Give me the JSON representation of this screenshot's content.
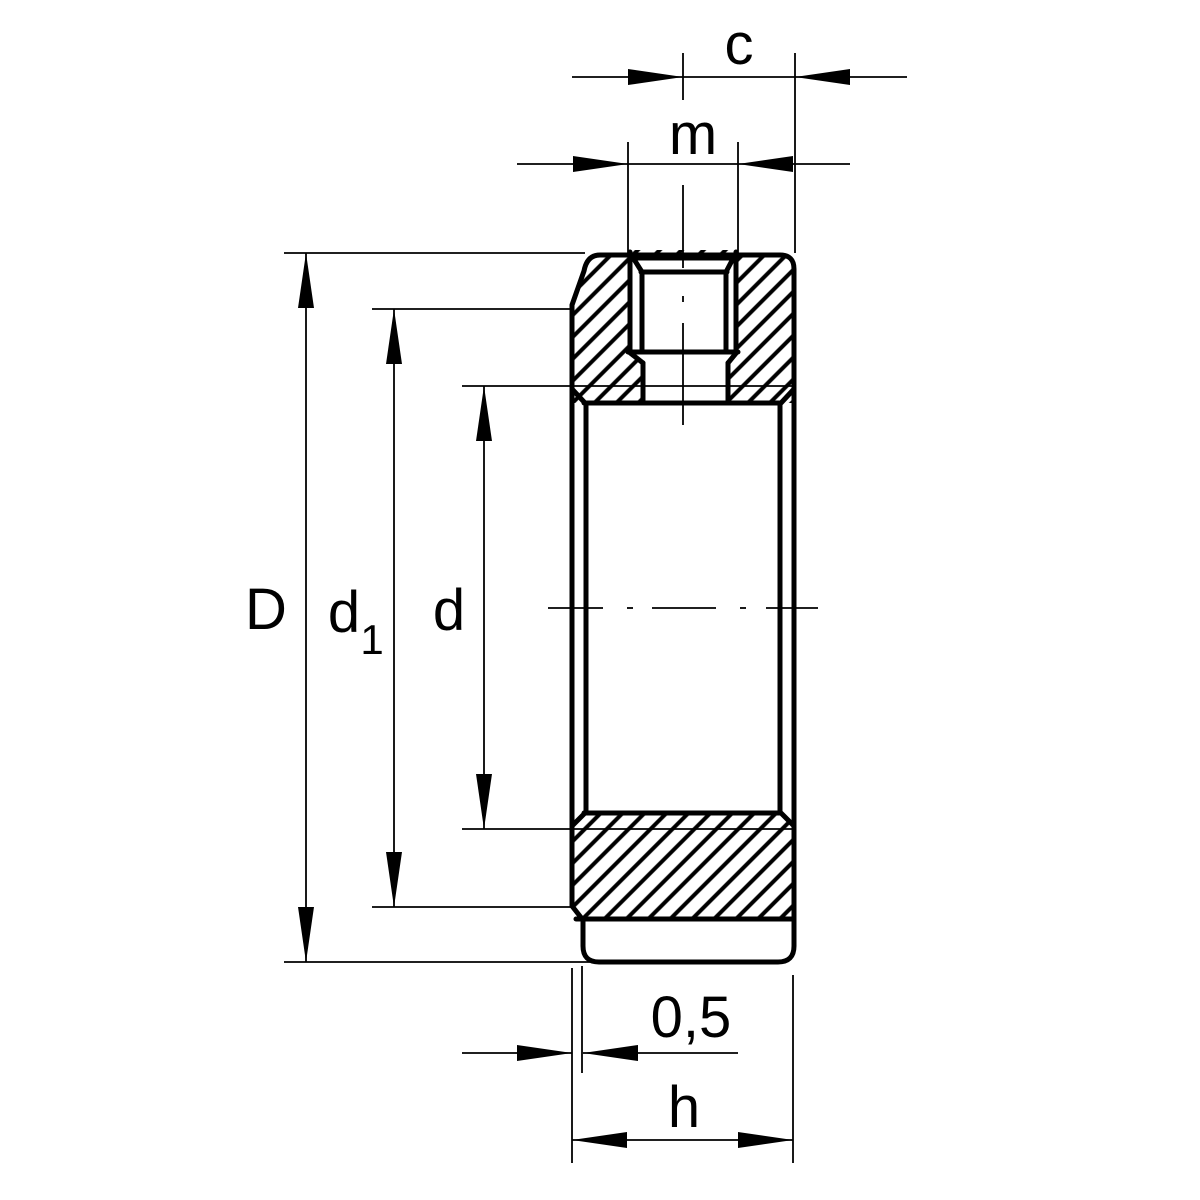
{
  "drawing": {
    "kind": "technical-cross-section-locknut",
    "labels": {
      "c": "c",
      "m": "m",
      "D": "D",
      "d1_main": "d",
      "d1_sub": "1",
      "d": "d",
      "relief": "0,5",
      "h": "h"
    },
    "colors": {
      "ink": "#000000",
      "background": "#ffffff"
    }
  }
}
